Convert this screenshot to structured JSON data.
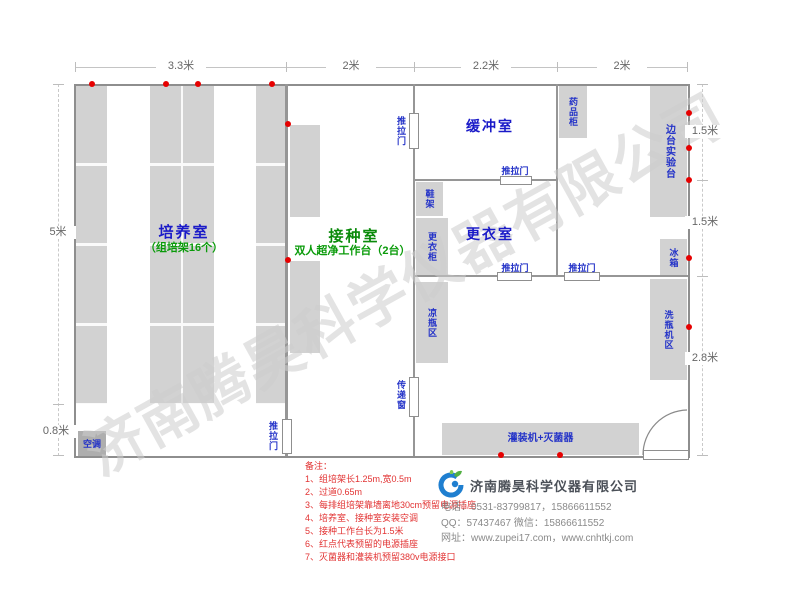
{
  "dims": {
    "top": [
      "3.3米",
      "2米",
      "2.2米",
      "2米"
    ],
    "left": [
      "5米",
      "0.8米"
    ],
    "right": [
      "1.5米",
      "1.5米",
      "2.8米"
    ]
  },
  "rooms": {
    "cultivation": {
      "name": "培养室",
      "sub": "（组培架16个）"
    },
    "inoculation": {
      "name": "接种室",
      "sub": "双人超净工作台（2台）"
    },
    "buffer": {
      "name": "缓冲室"
    },
    "changing": {
      "name": "更衣室"
    }
  },
  "furniture": {
    "medicine_cabinet": "药品柜",
    "side_bench": "边台实验台",
    "fridge": "冰箱",
    "shoe_rack": "鞋架",
    "wardrobe": "更衣柜",
    "cooling_area": "凉瓶区",
    "washer_area": "洗瓶机区",
    "filling_machine": "灌装机+灭菌器",
    "air_conditioner": "空调",
    "pass_window": "传递窗",
    "sliding_door": "推拉门"
  },
  "notes": {
    "title": "备注：",
    "items": [
      "1、组培架长1.25m,宽0.5m",
      "2、过道0.65m",
      "3、每排组培架靠墙离地30cm预留电源插座",
      "4、培养室、接种室安装空调",
      "5、接种工作台长为1.5米",
      "6、红点代表预留的电源插座",
      "7、灭菌器和灌装机预留380v电源接口"
    ]
  },
  "company": {
    "name": "济南腾昊科学仪器有限公司",
    "phone": "电话：0531-83799817，15866611552",
    "qq": "QQ：57437467    微信：15866611552",
    "website": "网址：www.zupei17.com，www.cnhtkj.com"
  },
  "watermark": "济南腾昊科学仪器有限公司",
  "colors": {
    "room_label_blue": "#1a1ac8",
    "room_label_green": "#0a8a0a",
    "furniture_fill": "#d2d2d2",
    "wall": "#969696",
    "socket_dot_red": "#e60000",
    "notes_red": "#e23333",
    "dimension_text": "#666666"
  }
}
